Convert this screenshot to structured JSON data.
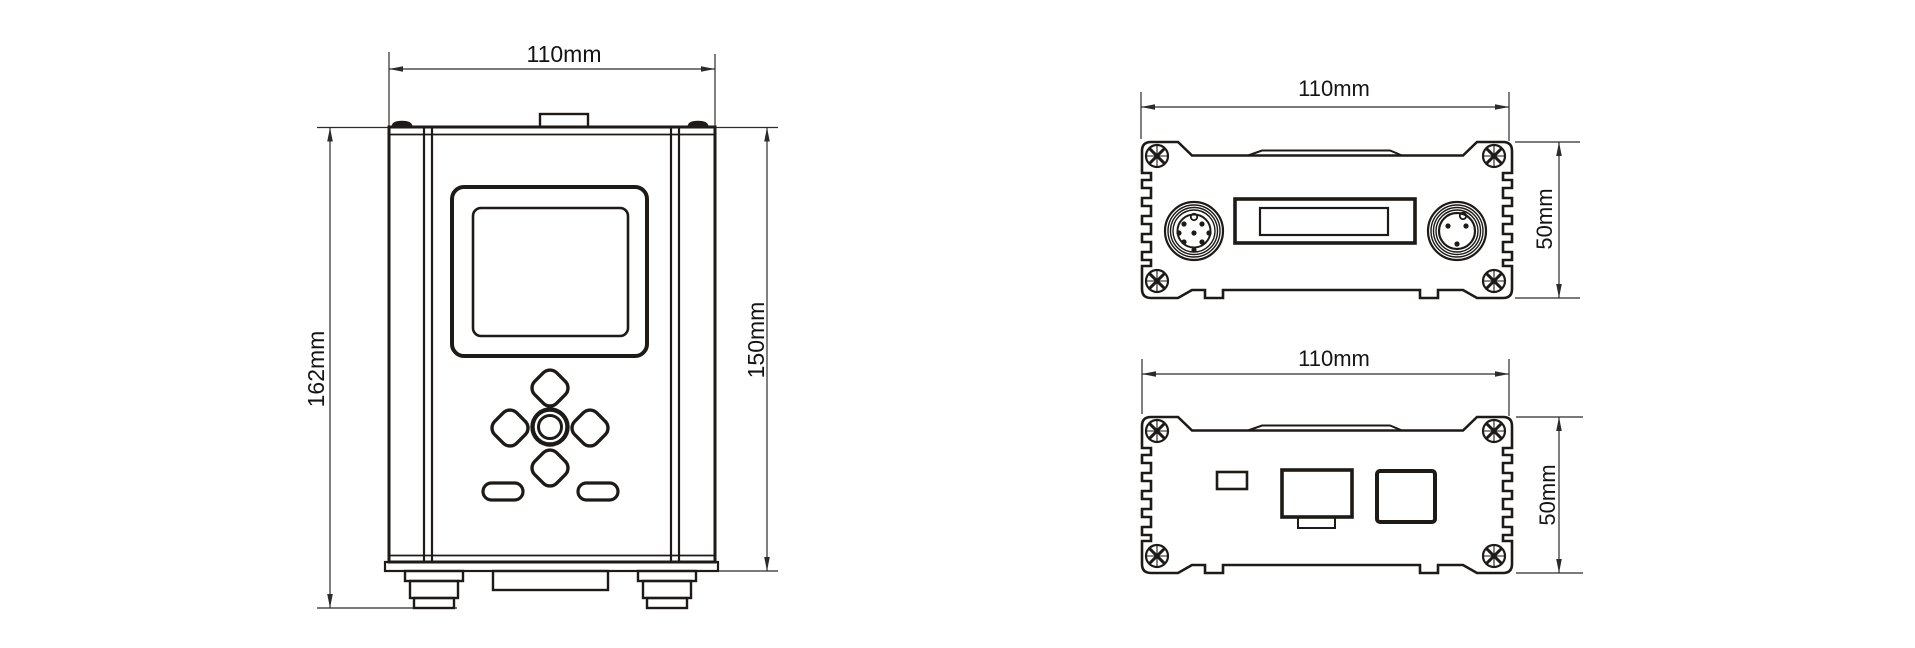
{
  "drawing": {
    "front_view": {
      "width_label": "110mm",
      "overall_height_label": "162mm",
      "body_height_label": "150mm"
    },
    "top_panel_view": {
      "width_label": "110mm",
      "height_label": "50mm"
    },
    "bottom_panel_view": {
      "width_label": "110mm",
      "height_label": "50mm"
    },
    "colors": {
      "ink": "#1d1a17",
      "dim_line": "#2b2b2b",
      "label_text": "#141414",
      "background": "#ffffff"
    }
  }
}
